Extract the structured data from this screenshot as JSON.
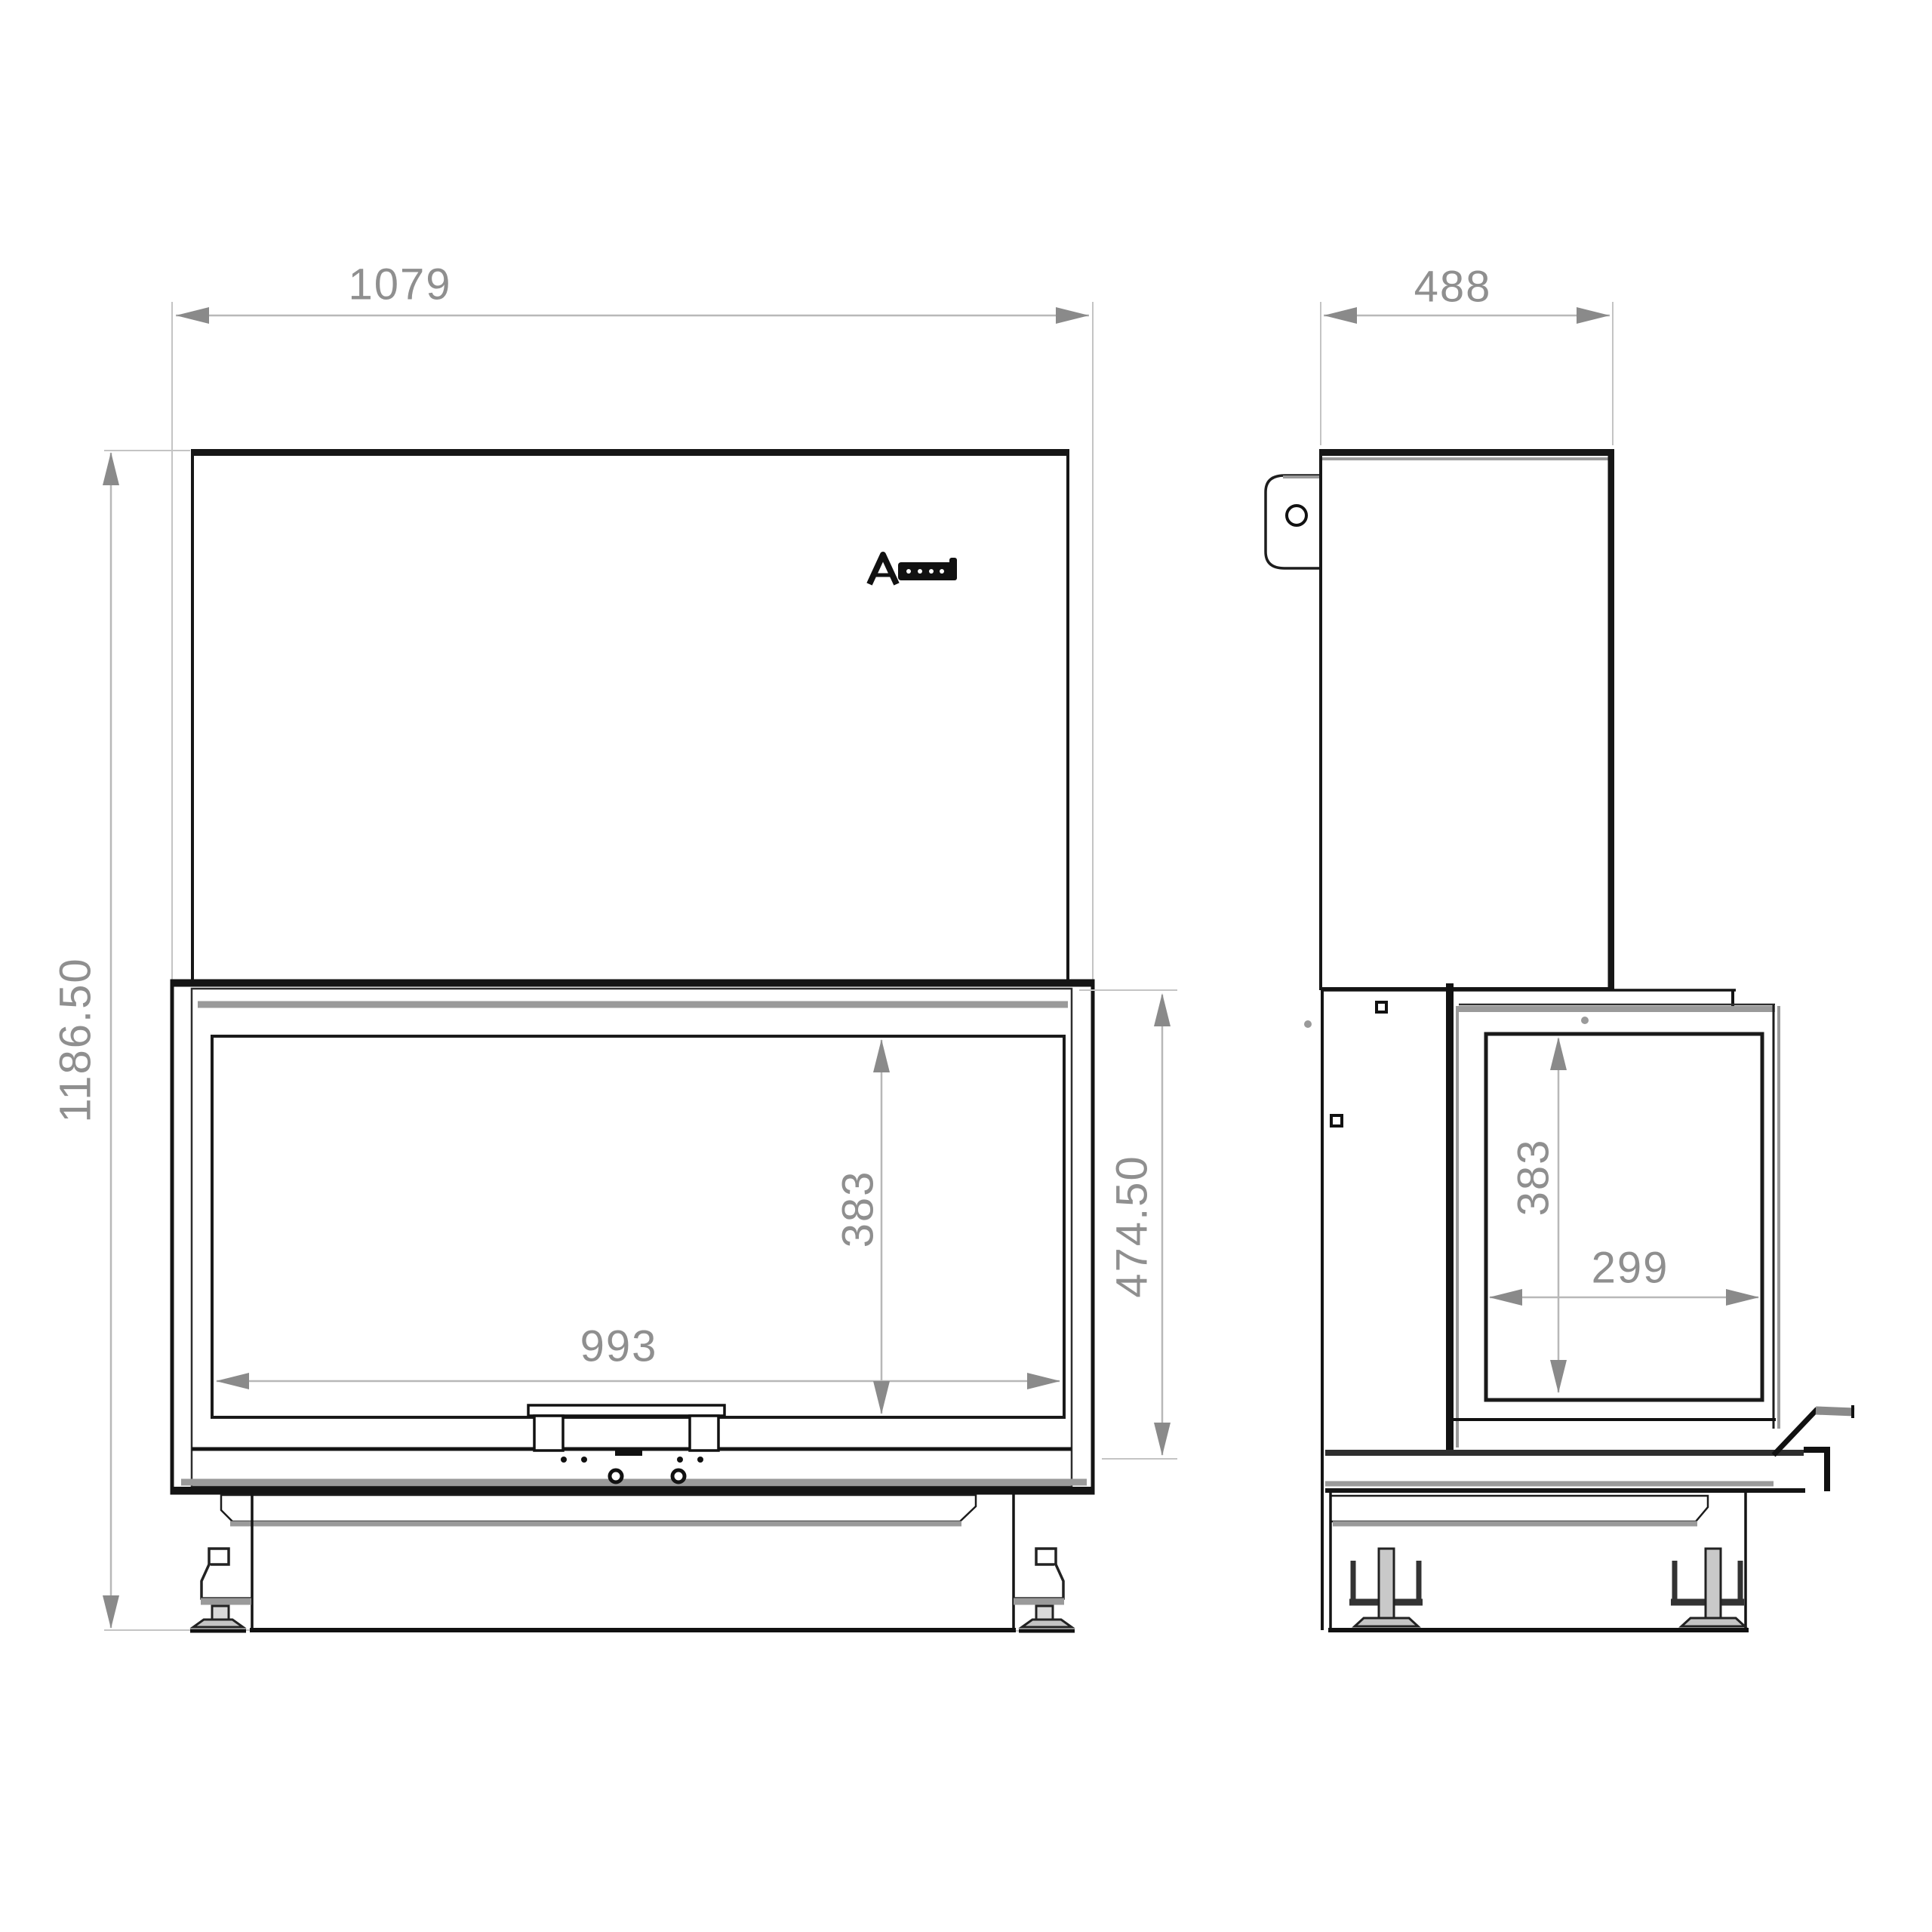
{
  "drawing": {
    "kind": "fireplace-insert-technical-drawing",
    "background": "#ffffff"
  },
  "colors": {
    "outline": "#141414",
    "mid_line": "#2e2e2e",
    "gray_band": "#9a9a9a",
    "dim_line": "#b8b8b8",
    "ext_line": "#c4c4c4",
    "dim_arrow": "#8a8a8a",
    "dim_text": "#8f8f8f"
  },
  "logo": {
    "letter": "A"
  },
  "front_view": {
    "overall_width": "1079",
    "overall_height": "1186.50",
    "glass_width": "993",
    "glass_height": "383",
    "firebox_height": "474.50"
  },
  "side_view": {
    "depth": "488",
    "glass_height": "383",
    "glass_depth": "299"
  }
}
